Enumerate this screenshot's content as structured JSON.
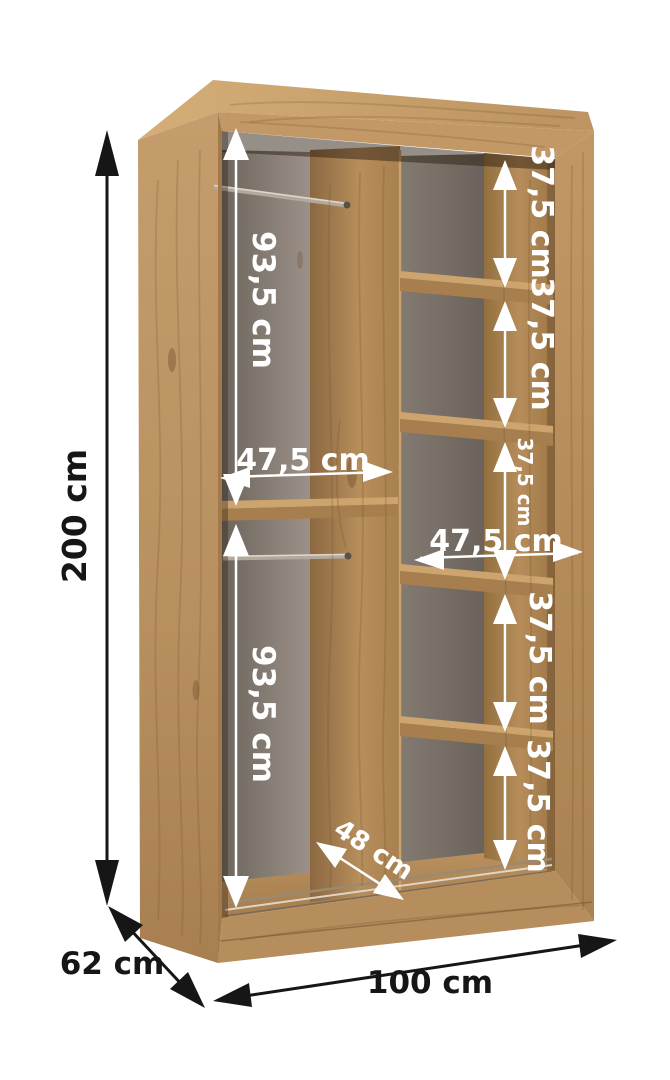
{
  "title": "Wardrobe interior dimension diagram",
  "product": {
    "type": "open sliding-door wardrobe carcass with shelves and hanging rails",
    "finish": "artisan oak"
  },
  "colors": {
    "background": "#ffffff",
    "wood": "#bf9764",
    "wood_dark": "#8c6841",
    "interior_back_wall": "#847a71",
    "rail_metal": "#b2a89d",
    "dimension_white": "#ffffff",
    "dimension_black": "#161616"
  },
  "overall_dimensions": {
    "height": "200 cm",
    "depth": "62 cm",
    "width": "100 cm"
  },
  "interior_dimensions": {
    "left_section": {
      "upper_height": "93,5 cm",
      "width": "47,5 cm",
      "lower_height": "93,5 cm"
    },
    "right_section": {
      "width": "47,5 cm",
      "shelf_gaps": [
        "37,5 cm",
        "37,5 cm",
        "37,5 cm",
        "37,5 cm",
        "37,5 cm"
      ]
    },
    "floor_depth": "48 cm"
  }
}
